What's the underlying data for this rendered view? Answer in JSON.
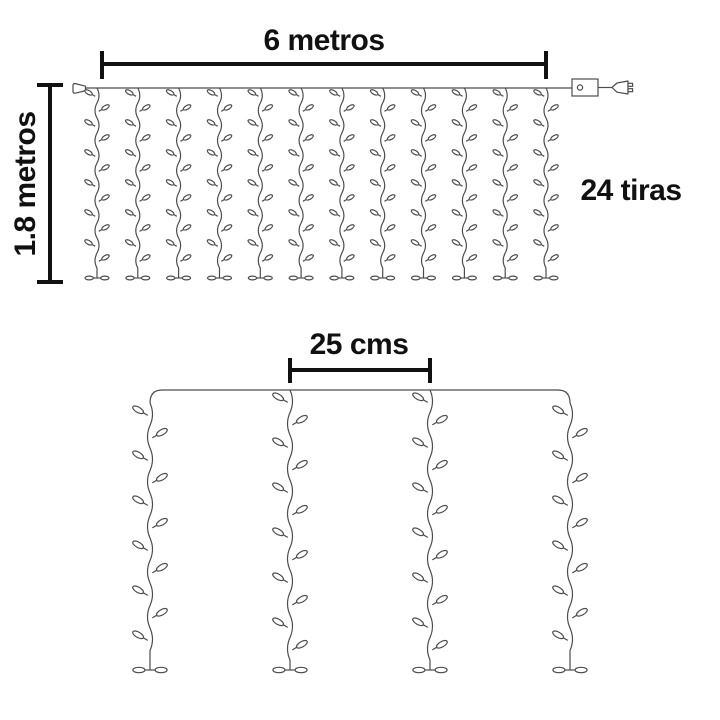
{
  "labels": {
    "width": "6 metros",
    "height": "1.8 metros",
    "strips": "24 tiras",
    "spacing": "25 cms"
  },
  "curtain": {
    "top_strands_shown": 12,
    "detail_strands_shown": 4
  },
  "colors": {
    "artwork_line": "#4d4d4d",
    "dimension_line": "#111111",
    "label_text": "#111111",
    "background": "#ffffff"
  }
}
